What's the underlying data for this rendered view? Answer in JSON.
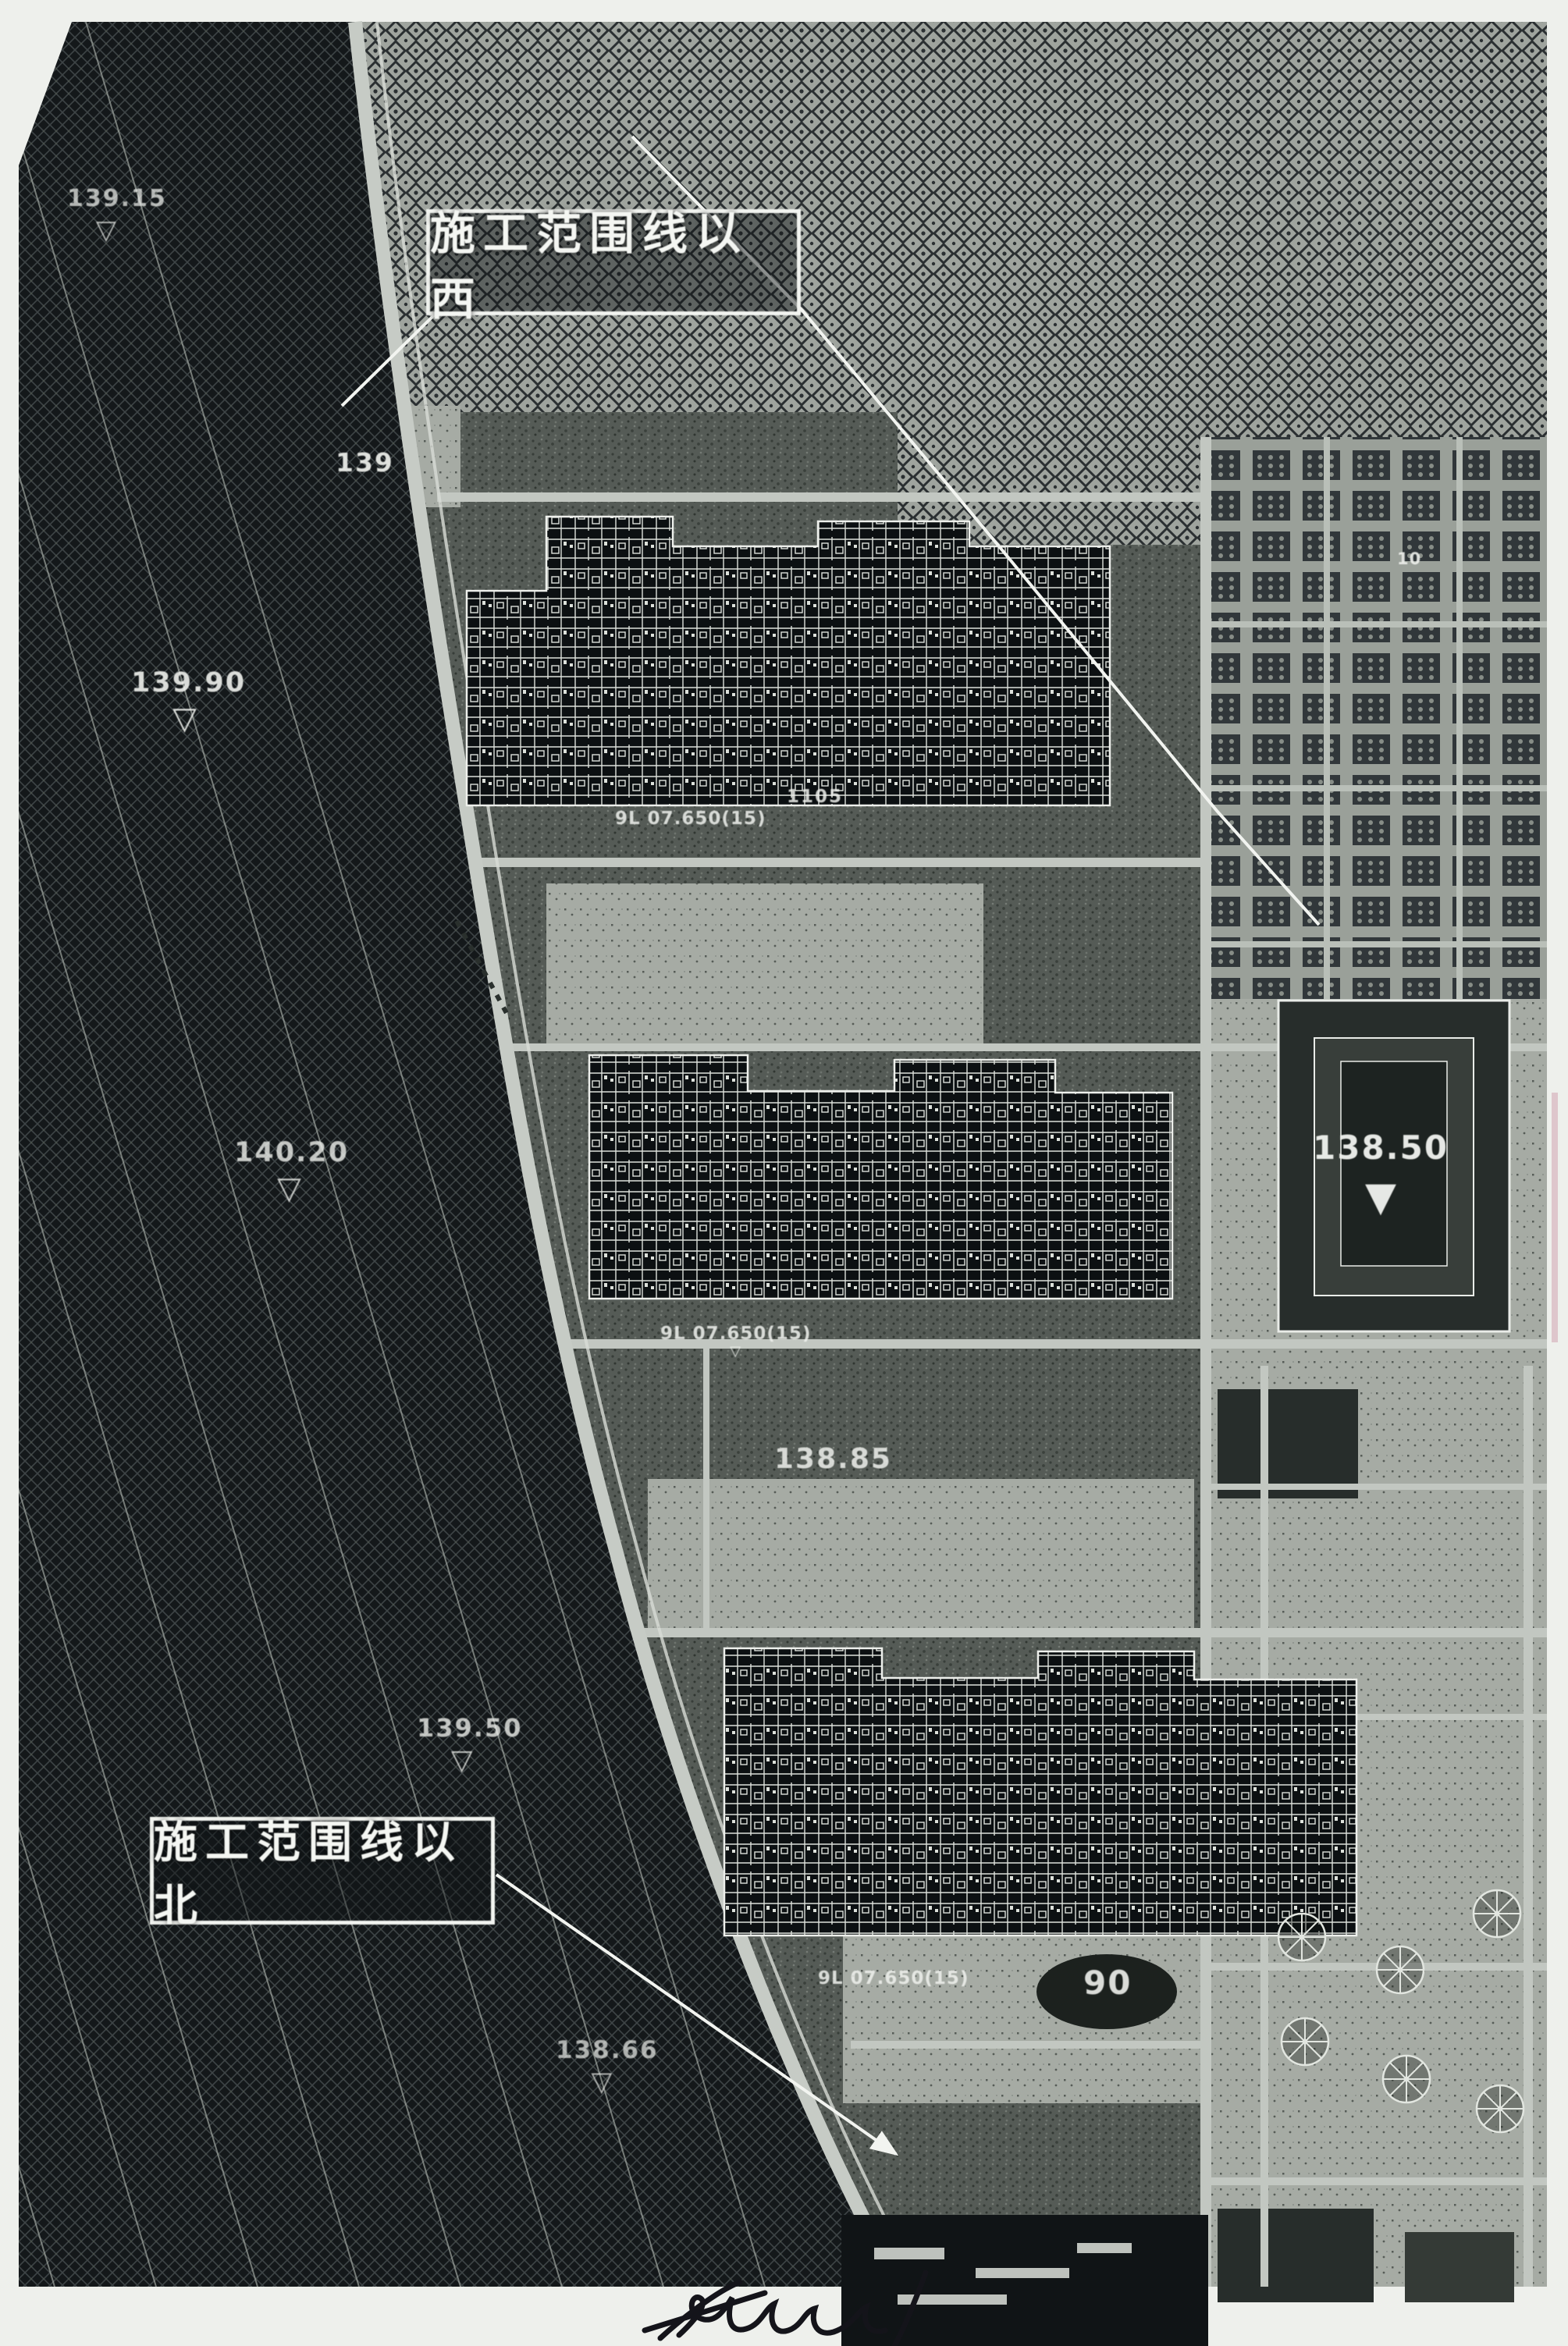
{
  "drawing": {
    "type": "scanned construction site plan",
    "boundary_labels": {
      "west": "施工范围线以西",
      "north": "施工范围线以北"
    }
  },
  "elevation_markers": [
    {
      "value": "139.15",
      "glyph": "▽"
    },
    {
      "value": "139.90",
      "glyph": "▽"
    },
    {
      "value": "139",
      "glyph": ""
    },
    {
      "value": "140.20",
      "glyph": "▽"
    },
    {
      "value": "139.50",
      "glyph": "▽"
    },
    {
      "value": "138.66",
      "glyph": "▽"
    },
    {
      "value": "138.50",
      "glyph": "▼"
    },
    {
      "value": "138.85",
      "glyph": ""
    },
    {
      "value": "90",
      "glyph": ""
    },
    {
      "value": "1105",
      "glyph": ""
    }
  ],
  "annotations": [
    {
      "text": "9L 07.650(15)",
      "glyph": ""
    },
    {
      "text": "9L 07.650(15)",
      "glyph": "▽"
    },
    {
      "text": "9L 07.650(15)",
      "glyph": ""
    },
    {
      "text": "10",
      "glyph": ""
    }
  ],
  "colors": {
    "paper": "#eef0ec",
    "site_ground": "#555b56",
    "river_hatch": "#14181a",
    "road": "#c6cbc5",
    "building": "#0c1012",
    "white_line": "#f2f4f0",
    "signature_ink": "#14141a",
    "scan_artifact_pink": "#d9bcc4"
  }
}
